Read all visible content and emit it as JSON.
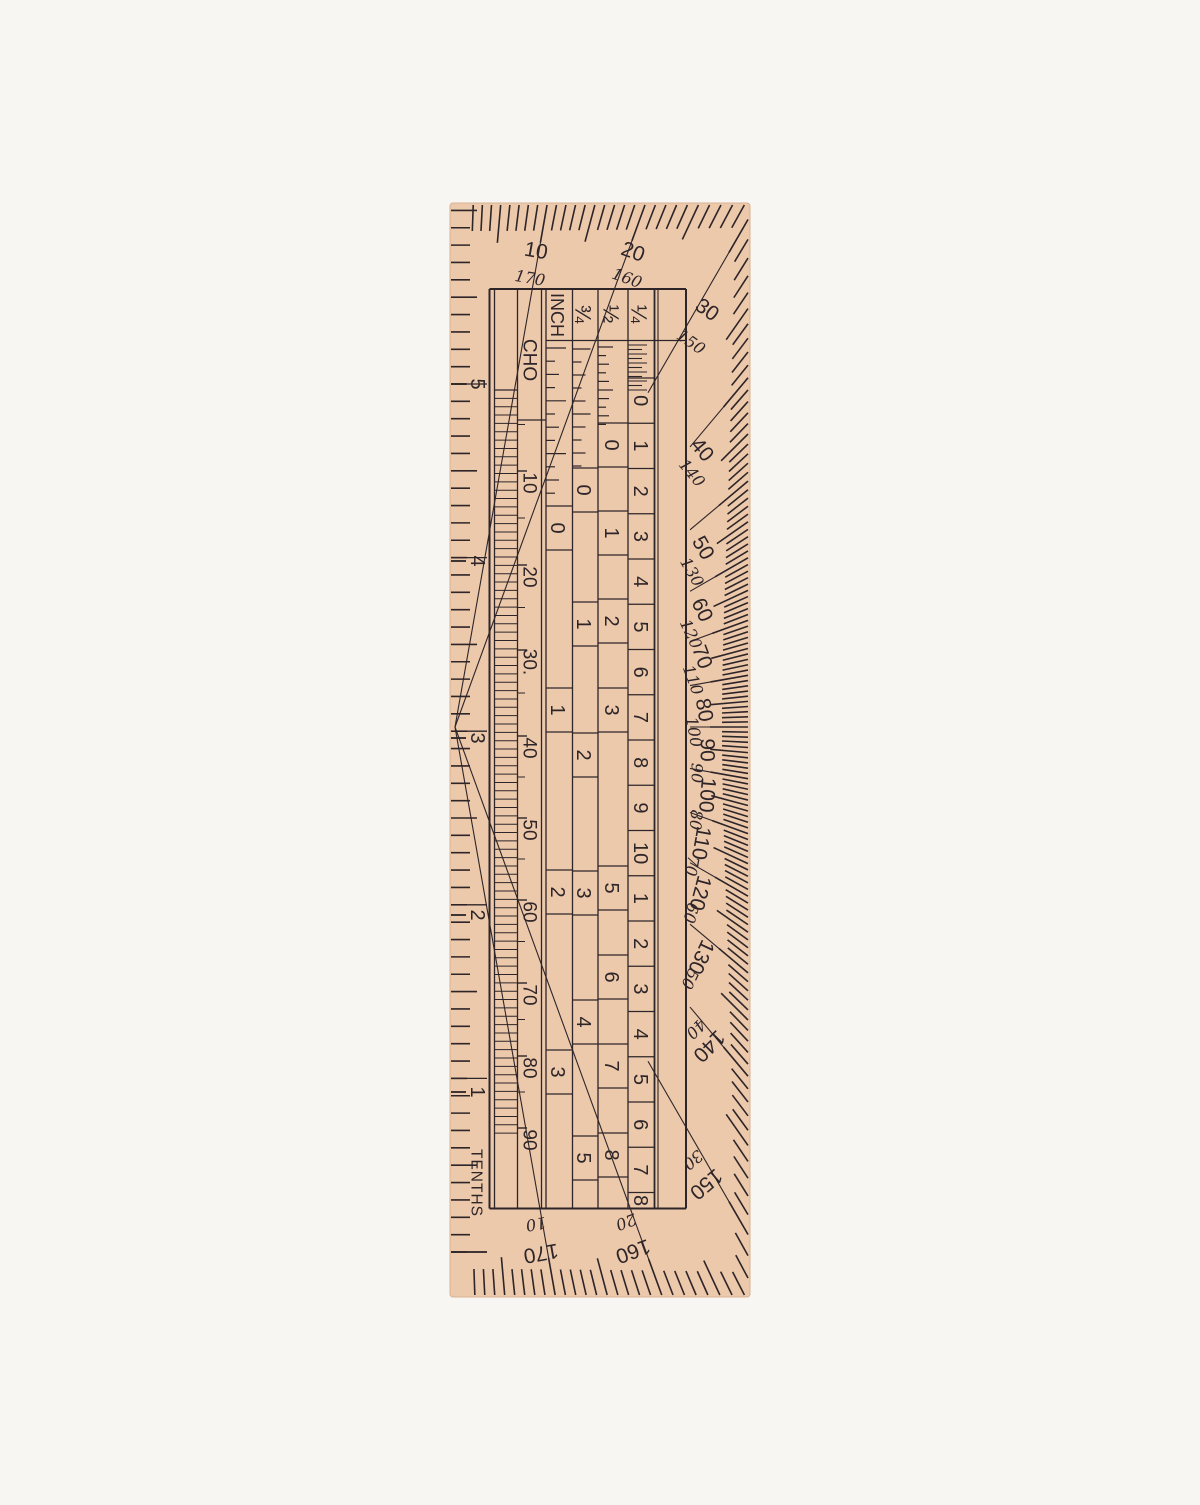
{
  "page": {
    "background": "#f7f6f3"
  },
  "ruler": {
    "body_color": "#ecc9ab",
    "body_edge_color": "#d9b292",
    "ink_color": "#2e2529",
    "body": {
      "x": 450,
      "y": 203,
      "width": 300,
      "height": 1094
    },
    "protractor_center": {
      "x": 455,
      "y": 727
    }
  },
  "labels": {
    "cho": "CHO",
    "inch": "INCH",
    "tenths": "TENTHS",
    "fraction_three_quarter": "¾",
    "fraction_half": "½",
    "fraction_quarter": "¼"
  },
  "tenths_scale": {
    "numbers": [
      {
        "v": "5",
        "y": 384
      },
      {
        "v": "4",
        "y": 561
      },
      {
        "v": "3",
        "y": 738
      },
      {
        "v": "2",
        "y": 915
      },
      {
        "v": "1",
        "y": 1092
      }
    ]
  },
  "cho_scale": {
    "numbers": [
      {
        "v": "10",
        "y": 483
      },
      {
        "v": "20",
        "y": 577
      },
      {
        "v": "30.",
        "y": 662
      },
      {
        "v": "40",
        "y": 748
      },
      {
        "v": "50",
        "y": 830
      },
      {
        "v": "60",
        "y": 912
      },
      {
        "v": "70",
        "y": 995
      },
      {
        "v": "80",
        "y": 1068
      },
      {
        "v": "90",
        "y": 1140
      }
    ]
  },
  "inch_scales": {
    "one_inch": [
      {
        "v": "0",
        "y": 528
      },
      {
        "v": "1",
        "y": 710
      },
      {
        "v": "2",
        "y": 892
      },
      {
        "v": "3",
        "y": 1072
      }
    ],
    "three_quarter": [
      {
        "v": "0",
        "y": 490
      },
      {
        "v": "1",
        "y": 624
      },
      {
        "v": "2",
        "y": 755
      },
      {
        "v": "3",
        "y": 893
      },
      {
        "v": "4",
        "y": 1022
      },
      {
        "v": "5",
        "y": 1158
      }
    ],
    "half": [
      {
        "v": "0",
        "y": 445
      },
      {
        "v": "1",
        "y": 533
      },
      {
        "v": "2",
        "y": 621
      },
      {
        "v": "3",
        "y": 710
      },
      {
        "v": "5",
        "y": 888
      },
      {
        "v": "6",
        "y": 977
      },
      {
        "v": "7",
        "y": 1066
      },
      {
        "v": "8",
        "y": 1155
      }
    ],
    "quarter_values": [
      "0",
      "1",
      "2",
      "3",
      "4",
      "5",
      "6",
      "7",
      "8",
      "9",
      "10",
      "1",
      "2",
      "3",
      "4",
      "5",
      "6",
      "7",
      "8"
    ]
  },
  "protractor": {
    "degree_labels": [
      {
        "deg": "10",
        "comp": "170",
        "mx": 536,
        "my": 251,
        "ix": 530,
        "iy": 278,
        "rot": 10
      },
      {
        "deg": "20",
        "comp": "160",
        "mx": 633,
        "my": 252,
        "ix": 627,
        "iy": 278,
        "rot": 20
      },
      {
        "deg": "30",
        "comp": "150",
        "mx": 707,
        "my": 310,
        "ix": 691,
        "iy": 342,
        "rot": 35
      },
      {
        "deg": "40",
        "comp": "140",
        "mx": 702,
        "my": 450,
        "ix": 692,
        "iy": 473,
        "rot": 50
      },
      {
        "deg": "50",
        "comp": "130",
        "mx": 703,
        "my": 548,
        "ix": 692,
        "iy": 572,
        "rot": 60
      },
      {
        "deg": "60",
        "comp": "120",
        "mx": 702,
        "my": 610,
        "ix": 691,
        "iy": 634,
        "rot": 65
      },
      {
        "deg": "70",
        "comp": "110",
        "mx": 702,
        "my": 657,
        "ix": 693,
        "iy": 680,
        "rot": 70
      },
      {
        "deg": "80",
        "comp": "100",
        "mx": 704,
        "my": 710,
        "ix": 694,
        "iy": 732,
        "rot": 80
      },
      {
        "deg": "90",
        "comp": "90",
        "mx": 707,
        "my": 750,
        "ix": 697,
        "iy": 773,
        "rot": 90
      },
      {
        "deg": "100",
        "comp": "80",
        "mx": 707,
        "my": 795,
        "ix": 696,
        "iy": 820,
        "rot": 95
      },
      {
        "deg": "110",
        "comp": "70",
        "mx": 701,
        "my": 843,
        "ix": 692,
        "iy": 866,
        "rot": 100
      },
      {
        "deg": "120",
        "comp": "60",
        "mx": 700,
        "my": 893,
        "ix": 691,
        "iy": 913,
        "rot": 105
      },
      {
        "deg": "130",
        "comp": "50",
        "mx": 701,
        "my": 957,
        "ix": 690,
        "iy": 979,
        "rot": 115
      },
      {
        "deg": "140",
        "comp": "40",
        "mx": 709,
        "my": 1046,
        "ix": 696,
        "iy": 1029,
        "rot": 135
      },
      {
        "deg": "150",
        "comp": "30",
        "mx": 706,
        "my": 1184,
        "ix": 693,
        "iy": 1160,
        "rot": 140
      },
      {
        "deg": "160",
        "comp": "20",
        "mx": 633,
        "my": 1251,
        "ix": 626,
        "iy": 1222,
        "rot": 160
      },
      {
        "deg": "170",
        "comp": "10",
        "mx": 541,
        "my": 1253,
        "ix": 536,
        "iy": 1224,
        "rot": 170
      }
    ]
  }
}
